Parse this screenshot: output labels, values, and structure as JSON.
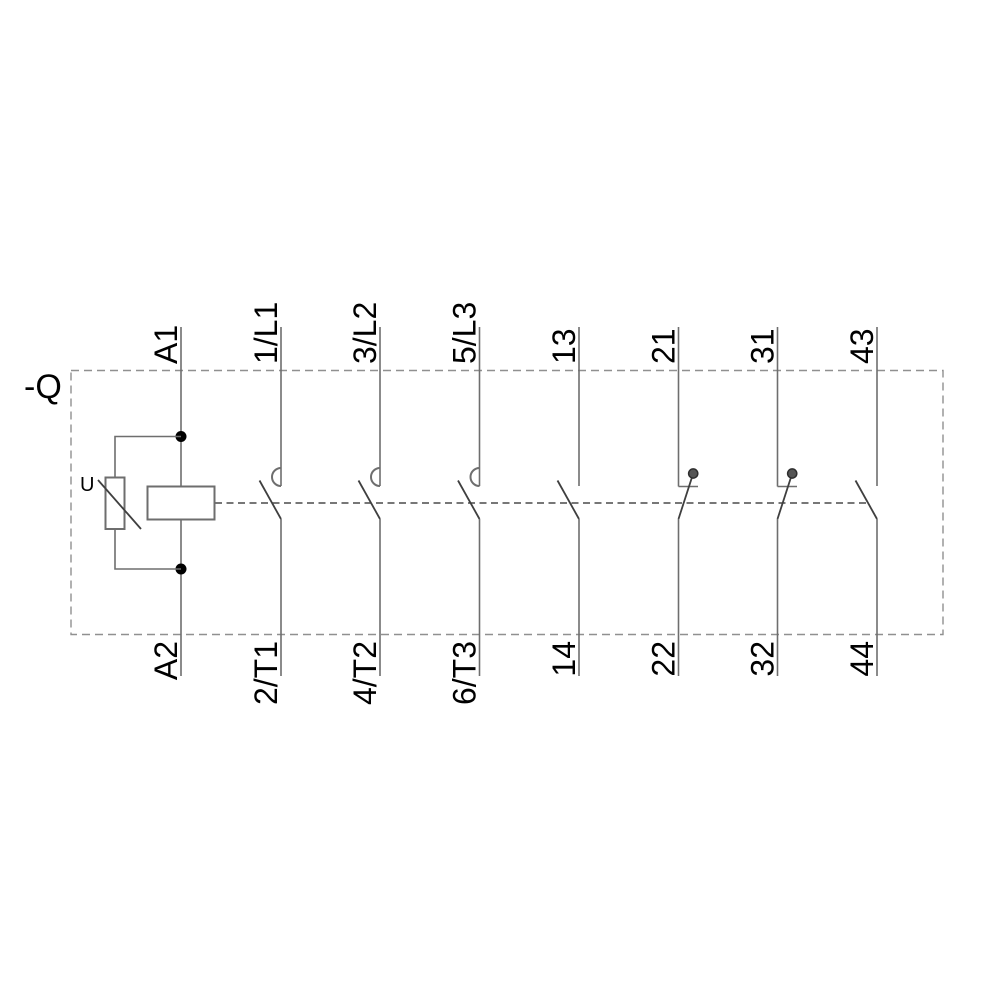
{
  "device_label": "-Q",
  "coil_branch": {
    "top_terminal": "A1",
    "bottom_terminal": "A2",
    "suppressor_label": "U"
  },
  "poles": [
    {
      "id": "1L1",
      "kind": "main-no-contact",
      "top": "1/L1",
      "bottom": "2/T1"
    },
    {
      "id": "3L2",
      "kind": "main-no-contact",
      "top": "3/L2",
      "bottom": "4/T2"
    },
    {
      "id": "5L3",
      "kind": "main-no-contact",
      "top": "5/L3",
      "bottom": "6/T3"
    },
    {
      "id": "13",
      "kind": "aux-no-contact",
      "top": "13",
      "bottom": "14"
    },
    {
      "id": "21",
      "kind": "aux-nc-contact",
      "top": "21",
      "bottom": "22"
    },
    {
      "id": "31",
      "kind": "aux-nc-contact",
      "top": "31",
      "bottom": "32"
    },
    {
      "id": "43",
      "kind": "aux-no-contact",
      "top": "43",
      "bottom": "44"
    }
  ],
  "colors": {
    "bg": "#ffffff",
    "wire": "#6e6e6e",
    "symbol": "#3f3f3f",
    "linkage": "#4a4a4a",
    "enclosure": "#909090",
    "label": "#000000"
  }
}
